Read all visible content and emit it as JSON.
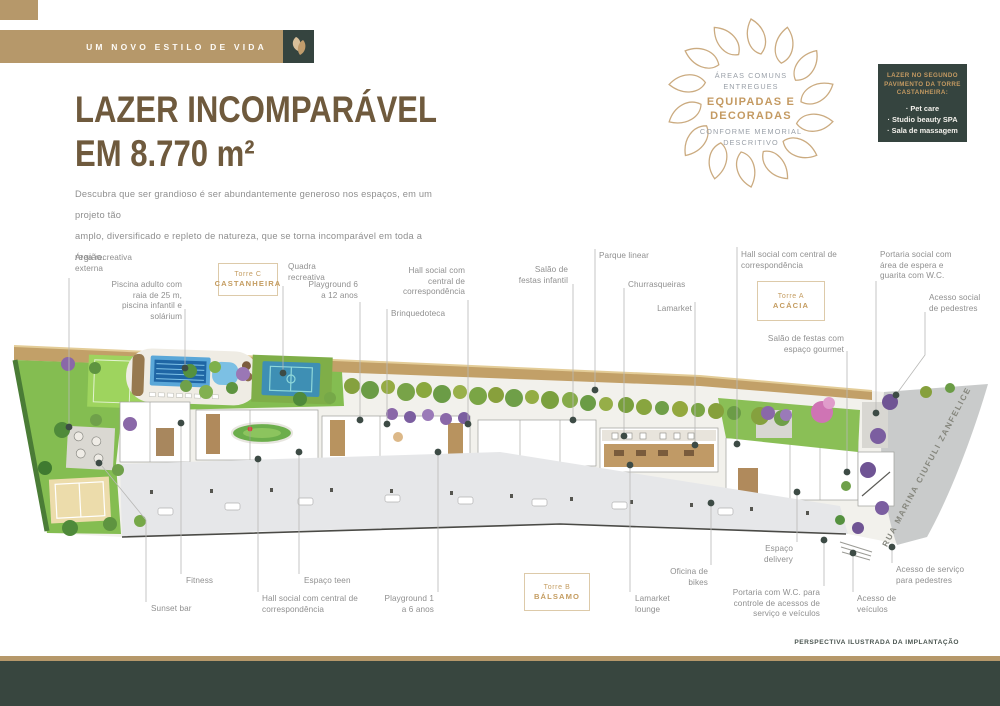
{
  "header": {
    "ribbon_label": "UM NOVO ESTILO DE VIDA",
    "title_line1": "LAZER INCOMPARÁVEL",
    "title_line2": "EM 8.770 m²",
    "description_line1": "Descubra que ser grandioso é ser abundantemente generoso nos espaços, em um projeto tão",
    "description_line2": "amplo, diversificado e repleto de natureza, que se torna incomparável em toda a região.",
    "accent_color": "#b6986a",
    "dark_color": "#35443f",
    "title_color": "#6f5a3d"
  },
  "mandala": {
    "line1": "ÁREAS COMUNS",
    "line2": "ENTREGUES",
    "line3": "EQUIPADAS E",
    "line4": "DECORADAS",
    "line5": "CONFORME MEMORIAL",
    "line6": "DESCRITIVO"
  },
  "info_box": {
    "heading": "LAZER NO SEGUNDO PAVIMENTO DA TORRE CASTANHEIRA:",
    "items": [
      "· Pet care",
      "· Studio beauty SPA",
      "· Sala de massagem"
    ]
  },
  "plan": {
    "street_name": "RUA MARINA CIUFULI ZANFELICE",
    "caption": "PERSPECTIVA ILUSTRADA DA IMPLANTAÇÃO",
    "towers": [
      {
        "line1": "Torre C",
        "line2": "CASTANHEIRA"
      },
      {
        "line1": "Torre A",
        "line2": "ACÁCIA"
      },
      {
        "line1": "Torre B",
        "line2": "BÁLSAMO"
      }
    ],
    "callouts": {
      "area_recreativa": "Área recreativa externa",
      "piscina": "Piscina adulto com raia de 25 m, piscina infantil e solárium",
      "quadra": "Quadra recreativa",
      "playground_6_12": "Playground 6 a 12 anos",
      "hall_social_c": "Hall social com central de correspondência",
      "brinquedoteca": "Brinquedoteca",
      "salao_festas_infantil": "Salão de festas infantil",
      "parque_linear": "Parque linear",
      "churrasqueiras": "Churrasqueiras",
      "lamarket": "Lamarket",
      "hall_social_a": "Hall social com central de correspondência",
      "salao_festas_gourmet": "Salão de festas com espaço gourmet",
      "portaria_social": "Portaria social com área de espera e guarita com W.C.",
      "acesso_social": "Acesso social de pedestres",
      "fitness": "Fitness",
      "sunset_bar": "Sunset bar",
      "espaco_teen": "Espaço teen",
      "hall_social_b": "Hall social com central de correspondência",
      "playground_1_6": "Playground 1 a 6 anos",
      "lamarket_lounge": "Lamarket lounge",
      "oficina_bikes": "Oficina de bikes",
      "espaco_delivery": "Espaço delivery",
      "portaria_servico": "Portaria com W.C. para controle de acessos de serviço e veículos",
      "acesso_servico": "Acesso de serviço para pedestres",
      "acesso_veiculos": "Acesso de veículos"
    }
  }
}
